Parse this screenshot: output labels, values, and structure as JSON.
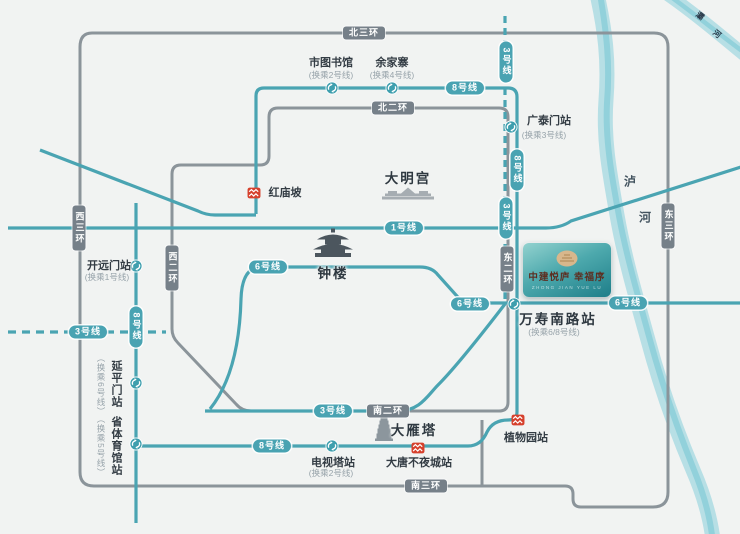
{
  "map": {
    "background": "#f1f3f2",
    "colors": {
      "metro_line": "#4aa4b2",
      "road": "#8b949a",
      "road_pill": "#768089",
      "metro_pill": "#49a3b2",
      "river": "#b7dfe5",
      "river_core": "#8ecfd9",
      "red_marker": "#d6402c",
      "station_fill": "#3f9fae",
      "text_dark": "#333c44",
      "text_note": "#97a3aa",
      "logo_gradient_from": "#93d2cf",
      "logo_gradient_to": "#1e7e89",
      "logo_text": "#5d2e21",
      "emblem_gold": "#d8b78c"
    },
    "road_pills": [
      {
        "t": "北三环",
        "x": 364,
        "y": 33,
        "v": false
      },
      {
        "t": "北二环",
        "x": 393,
        "y": 108,
        "v": false
      },
      {
        "t": "西三环",
        "x": 79,
        "y": 228,
        "v": true
      },
      {
        "t": "西二环",
        "x": 172,
        "y": 268,
        "v": true
      },
      {
        "t": "东二环",
        "x": 507,
        "y": 269,
        "v": true
      },
      {
        "t": "东三环",
        "x": 668,
        "y": 226,
        "v": true
      },
      {
        "t": "南二环",
        "x": 388,
        "y": 411,
        "v": false
      },
      {
        "t": "南三环",
        "x": 426,
        "y": 486,
        "v": false
      }
    ],
    "line_pills": [
      {
        "t": "8号线",
        "x": 465,
        "y": 88,
        "v": false
      },
      {
        "t": "3号线",
        "x": 506,
        "y": 62,
        "v": true
      },
      {
        "t": "8号线",
        "x": 517,
        "y": 170,
        "v": true
      },
      {
        "t": "3号线",
        "x": 506,
        "y": 218,
        "v": true
      },
      {
        "t": "1号线",
        "x": 404,
        "y": 228,
        "v": false
      },
      {
        "t": "6号线",
        "x": 268,
        "y": 267,
        "v": false
      },
      {
        "t": "6号线",
        "x": 470,
        "y": 304,
        "v": false
      },
      {
        "t": "6号线",
        "x": 628,
        "y": 303,
        "v": false
      },
      {
        "t": "3号线",
        "x": 88,
        "y": 332,
        "v": false
      },
      {
        "t": "8号线",
        "x": 136,
        "y": 327,
        "v": true
      },
      {
        "t": "3号线",
        "x": 333,
        "y": 411,
        "v": false
      },
      {
        "t": "8号线",
        "x": 272,
        "y": 446,
        "v": false
      }
    ],
    "transfer_stations": [
      {
        "name": "市图书馆",
        "x": 332,
        "y": 88
      },
      {
        "name": "余家寨",
        "x": 392,
        "y": 88
      },
      {
        "name": "广泰门站",
        "x": 511,
        "y": 127
      },
      {
        "name": "开远门站",
        "x": 136,
        "y": 266
      },
      {
        "name": "延平门站",
        "x": 136,
        "y": 383
      },
      {
        "name": "省体育馆站",
        "x": 136,
        "y": 444
      },
      {
        "name": "电视塔站",
        "x": 332,
        "y": 446
      },
      {
        "name": "万寿南路站",
        "x": 514,
        "y": 304
      }
    ],
    "red_markers": [
      {
        "name": "红庙坡",
        "x": 254,
        "y": 192
      },
      {
        "name": "大唐不夜城站",
        "x": 418,
        "y": 447
      },
      {
        "name": "植物园站",
        "x": 518,
        "y": 419
      }
    ],
    "labels": [
      {
        "t": "市图书馆",
        "x": 331,
        "y": 62,
        "cls": "name"
      },
      {
        "t": "(换乘2号线)",
        "x": 331,
        "y": 75,
        "cls": "note"
      },
      {
        "t": "余家寨",
        "x": 392,
        "y": 62,
        "cls": "name"
      },
      {
        "t": "(换乘4号线)",
        "x": 392,
        "y": 75,
        "cls": "note"
      },
      {
        "t": "广泰门站",
        "x": 549,
        "y": 120,
        "cls": "name"
      },
      {
        "t": "(换乘3号线)",
        "x": 544,
        "y": 135,
        "cls": "note"
      },
      {
        "t": "红庙坡",
        "x": 285,
        "y": 192,
        "cls": "name"
      },
      {
        "t": "大明宫",
        "x": 408,
        "y": 177,
        "cls": "big"
      },
      {
        "t": "钟楼",
        "x": 333,
        "y": 272,
        "cls": "big"
      },
      {
        "t": "开远门站",
        "x": 109,
        "y": 265,
        "cls": "name"
      },
      {
        "t": "(换乘1号线)",
        "x": 107,
        "y": 277,
        "cls": "note"
      },
      {
        "t": "延平门站",
        "x": 116,
        "y": 384,
        "cls": "name",
        "vert": true
      },
      {
        "t": "（换乘6号线）",
        "x": 101,
        "y": 385,
        "cls": "note",
        "vert": true
      },
      {
        "t": "省体育馆站",
        "x": 116,
        "y": 446,
        "cls": "name",
        "vert": true
      },
      {
        "t": "（换乘5号线）",
        "x": 101,
        "y": 446,
        "cls": "note",
        "vert": true
      },
      {
        "t": "万寿南路站",
        "x": 558,
        "y": 318,
        "cls": "big"
      },
      {
        "t": "(换乘6/8号线)",
        "x": 554,
        "y": 332,
        "cls": "note"
      },
      {
        "t": "电视塔站",
        "x": 333,
        "y": 462,
        "cls": "name"
      },
      {
        "t": "(换乘2号线)",
        "x": 331,
        "y": 473,
        "cls": "note"
      },
      {
        "t": "大唐不夜城站",
        "x": 419,
        "y": 462,
        "cls": "name"
      },
      {
        "t": "植物园站",
        "x": 526,
        "y": 437,
        "cls": "name"
      },
      {
        "t": "大雁塔",
        "x": 414,
        "y": 429,
        "cls": "big"
      },
      {
        "t": "泸",
        "x": 630,
        "y": 181,
        "cls": "river"
      },
      {
        "t": "河",
        "x": 645,
        "y": 217,
        "cls": "river"
      },
      {
        "t": "灞",
        "x": 700,
        "y": 16,
        "cls": "river-sm",
        "rot": 38
      },
      {
        "t": "河",
        "x": 717,
        "y": 34,
        "cls": "river-sm",
        "rot": 38
      }
    ]
  },
  "logo_card": {
    "title": "中建悦庐 幸福序",
    "subtitle": "ZHONG JIAN YUE LU"
  }
}
